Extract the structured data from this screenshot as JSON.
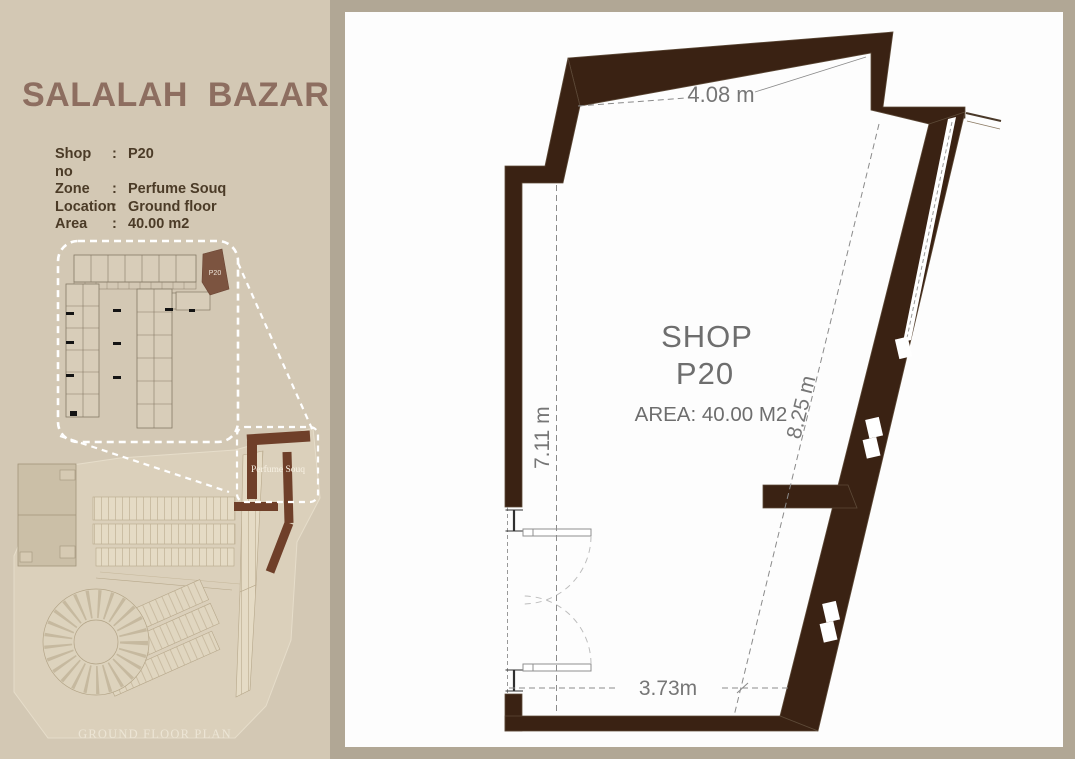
{
  "colors": {
    "frame_bg": "#b1a795",
    "sidebar_bg": "#d3c8b4",
    "panel_bg": "#fdfdfd",
    "wall_brown": "#3a2213",
    "title_brown": "#8d6e60",
    "info_text": "#4b3b27",
    "dimension_gray": "#767676",
    "souq_highlight_brown": "#6f3f29",
    "inset_cell_fill": "#d8cdb9",
    "dashed_callout_white": "#ffffff"
  },
  "sidebar": {
    "title": "SALALAH  BAZAR",
    "details": [
      {
        "label": "Shop no",
        "sep": ":",
        "value": "P20"
      },
      {
        "label": "Zone",
        "sep": ":",
        "value": "Perfume Souq"
      },
      {
        "label": "Location",
        "sep": ":",
        "value": "Ground floor"
      },
      {
        "label": "Area",
        "sep": ":",
        "value": "40.00 m2"
      }
    ],
    "inset": {
      "shop_label": "P20"
    },
    "site": {
      "zone_label": "Perfume Souq",
      "caption": "GROUND FLOOR PLAN"
    }
  },
  "plan": {
    "shop_line1": "SHOP",
    "shop_line2": "P20",
    "area_text": "AREA: 40.00 M2",
    "dims": {
      "top": "4.08 m",
      "left": "7.11 m",
      "right": "8.25 m",
      "bottom": "3.73m"
    }
  }
}
